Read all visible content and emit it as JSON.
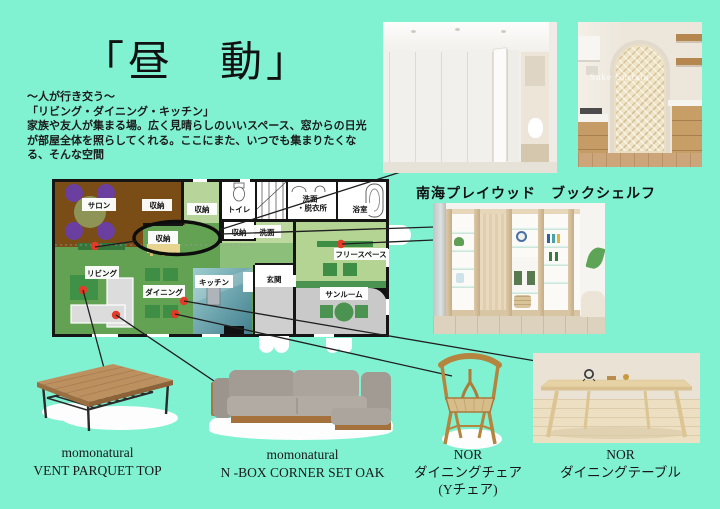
{
  "title": "「昼　動」",
  "intro": {
    "line1": "〜人が行き交う〜",
    "line2": "「リビング・ダイニング・キッチン」",
    "line3": "家族や友人が集まる場。広く見晴らしのいいスペース、窓からの日光",
    "line4": "が部屋全体を照らしてくれる。ここにまた、いつでも集まりたくな",
    "line5": "る、そんな空間"
  },
  "floor_plan": {
    "rooms": {
      "salon": "サロン",
      "storage": "収納",
      "toilet": "トイレ",
      "washroom_line1": "洗面",
      "washroom_line2": "・脱衣所",
      "bath": "浴室",
      "washstand": "洗面",
      "living": "リビング",
      "dining": "ダイニング",
      "kitchen": "キッチン",
      "entrance": "玄関",
      "free_space": "フリースペース",
      "sunroom": "サンルーム"
    }
  },
  "shelf_section": {
    "label": "南海プレイウッド　ブックシェルフ"
  },
  "photos": {
    "kitchen_arch_watermark": "Suke Curtain"
  },
  "products": [
    {
      "brand": "momonatural",
      "name": "VENT PARQUET TOP"
    },
    {
      "brand": "momonatural",
      "name": "N -BOX CORNER SET OAK"
    },
    {
      "brand": "NOR",
      "name": "ダイニングチェア",
      "subname": "(Yチェア)"
    },
    {
      "brand": "NOR",
      "name": "ダイニングテーブル"
    }
  ],
  "colors": {
    "background": "#80f2d2",
    "marker_red": "#e23b28",
    "living_green": "#64a253",
    "accent_green": "#3e8e46",
    "salon_brown": "#7a4c16"
  }
}
